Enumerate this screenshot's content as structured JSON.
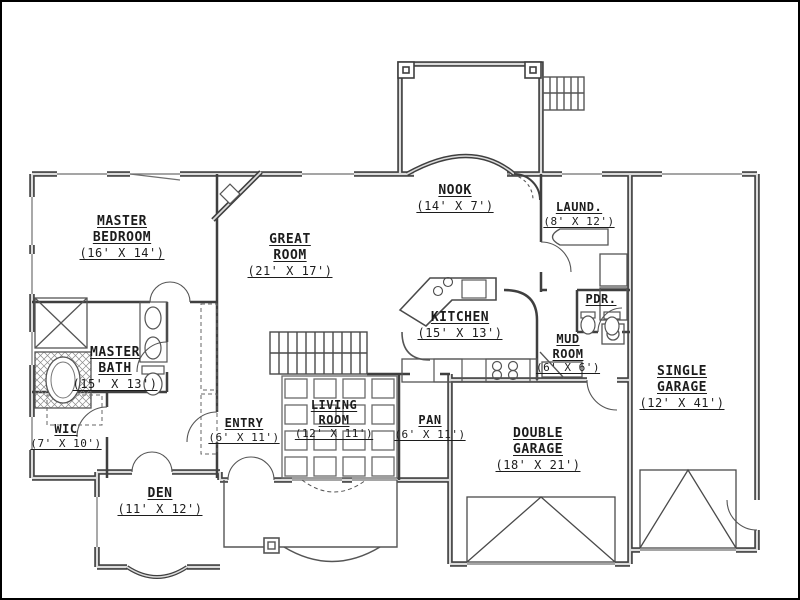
{
  "drawing": {
    "kind": "single-story house floor plan, black-and-white architectural line drawing",
    "colors": {
      "background": "#ffffff",
      "wall": "#3f3f3f",
      "wall_inner": "#dcdcdc",
      "thin_line": "#555555",
      "frame": "#000000"
    }
  },
  "rooms": [
    {
      "id": "master-bedroom",
      "name1": "MASTER",
      "name2": "BEDROOM",
      "dims": "(16' X 14')"
    },
    {
      "id": "great-room",
      "name1": "GREAT",
      "name2": "ROOM",
      "dims": "(21' X 17')"
    },
    {
      "id": "nook",
      "name1": "NOOK",
      "dims": "(14' X 7')"
    },
    {
      "id": "laundry",
      "name1": "LAUND.",
      "dims": "(8' X 12')"
    },
    {
      "id": "master-bath",
      "name1": "MASTER",
      "name2": "BATH",
      "dims": "(15' X 13')"
    },
    {
      "id": "kitchen",
      "name1": "KITCHEN",
      "dims": "(15' X 13')"
    },
    {
      "id": "powder",
      "name1": "PDR.",
      "dims": ""
    },
    {
      "id": "mud-room",
      "name1": "MUD",
      "name2": "ROOM",
      "dims": "(6' X 6')"
    },
    {
      "id": "single-garage",
      "name1": "SINGLE",
      "name2": "GARAGE",
      "dims": "(12' X 41')"
    },
    {
      "id": "wic",
      "name1": "WIC",
      "dims": "(7' X 10')"
    },
    {
      "id": "entry",
      "name1": "ENTRY",
      "dims": "(6' X 11')"
    },
    {
      "id": "living-room",
      "name1": "LIVING",
      "name2": "ROOM",
      "dims": "(12' X 11')"
    },
    {
      "id": "pantry",
      "name1": "PAN",
      "dims": "(6' X 11')"
    },
    {
      "id": "double-garage",
      "name1": "DOUBLE",
      "name2": "GARAGE",
      "dims": "(18' X 21')"
    },
    {
      "id": "den",
      "name1": "DEN",
      "dims": "(11' X 12')"
    }
  ]
}
